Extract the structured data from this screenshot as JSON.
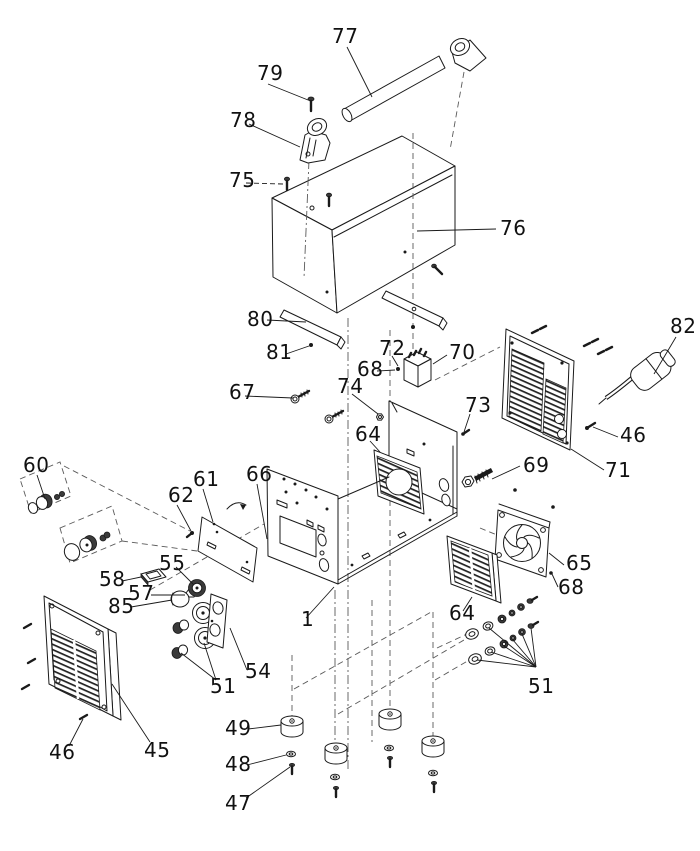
{
  "type": "exploded-parts-diagram",
  "background": "#ffffff",
  "line_color": "#1a1a1a",
  "callouts": [
    {
      "id": "77",
      "text": "77"
    },
    {
      "id": "79",
      "text": "79"
    },
    {
      "id": "78",
      "text": "78"
    },
    {
      "id": "75",
      "text": "75"
    },
    {
      "id": "76",
      "text": "76"
    },
    {
      "id": "80",
      "text": "80"
    },
    {
      "id": "81",
      "text": "81"
    },
    {
      "id": "72",
      "text": "72"
    },
    {
      "id": "68-top",
      "text": "68"
    },
    {
      "id": "70",
      "text": "70"
    },
    {
      "id": "82",
      "text": "82"
    },
    {
      "id": "67",
      "text": "67"
    },
    {
      "id": "74",
      "text": "74"
    },
    {
      "id": "64-top",
      "text": "64"
    },
    {
      "id": "73",
      "text": "73"
    },
    {
      "id": "46-right",
      "text": "46"
    },
    {
      "id": "71",
      "text": "71"
    },
    {
      "id": "69",
      "text": "69"
    },
    {
      "id": "60",
      "text": "60"
    },
    {
      "id": "62",
      "text": "62"
    },
    {
      "id": "61",
      "text": "61"
    },
    {
      "id": "66",
      "text": "66"
    },
    {
      "id": "65",
      "text": "65"
    },
    {
      "id": "68-bottom",
      "text": "68"
    },
    {
      "id": "55",
      "text": "55"
    },
    {
      "id": "58",
      "text": "58"
    },
    {
      "id": "57",
      "text": "57"
    },
    {
      "id": "85",
      "text": "85"
    },
    {
      "id": "1",
      "text": "1"
    },
    {
      "id": "64-bottom",
      "text": "64"
    },
    {
      "id": "54",
      "text": "54"
    },
    {
      "id": "51-left",
      "text": "51"
    },
    {
      "id": "51-right",
      "text": "51"
    },
    {
      "id": "49",
      "text": "49"
    },
    {
      "id": "45",
      "text": "45"
    },
    {
      "id": "46-left",
      "text": "46"
    },
    {
      "id": "48",
      "text": "48"
    },
    {
      "id": "47",
      "text": "47"
    }
  ]
}
